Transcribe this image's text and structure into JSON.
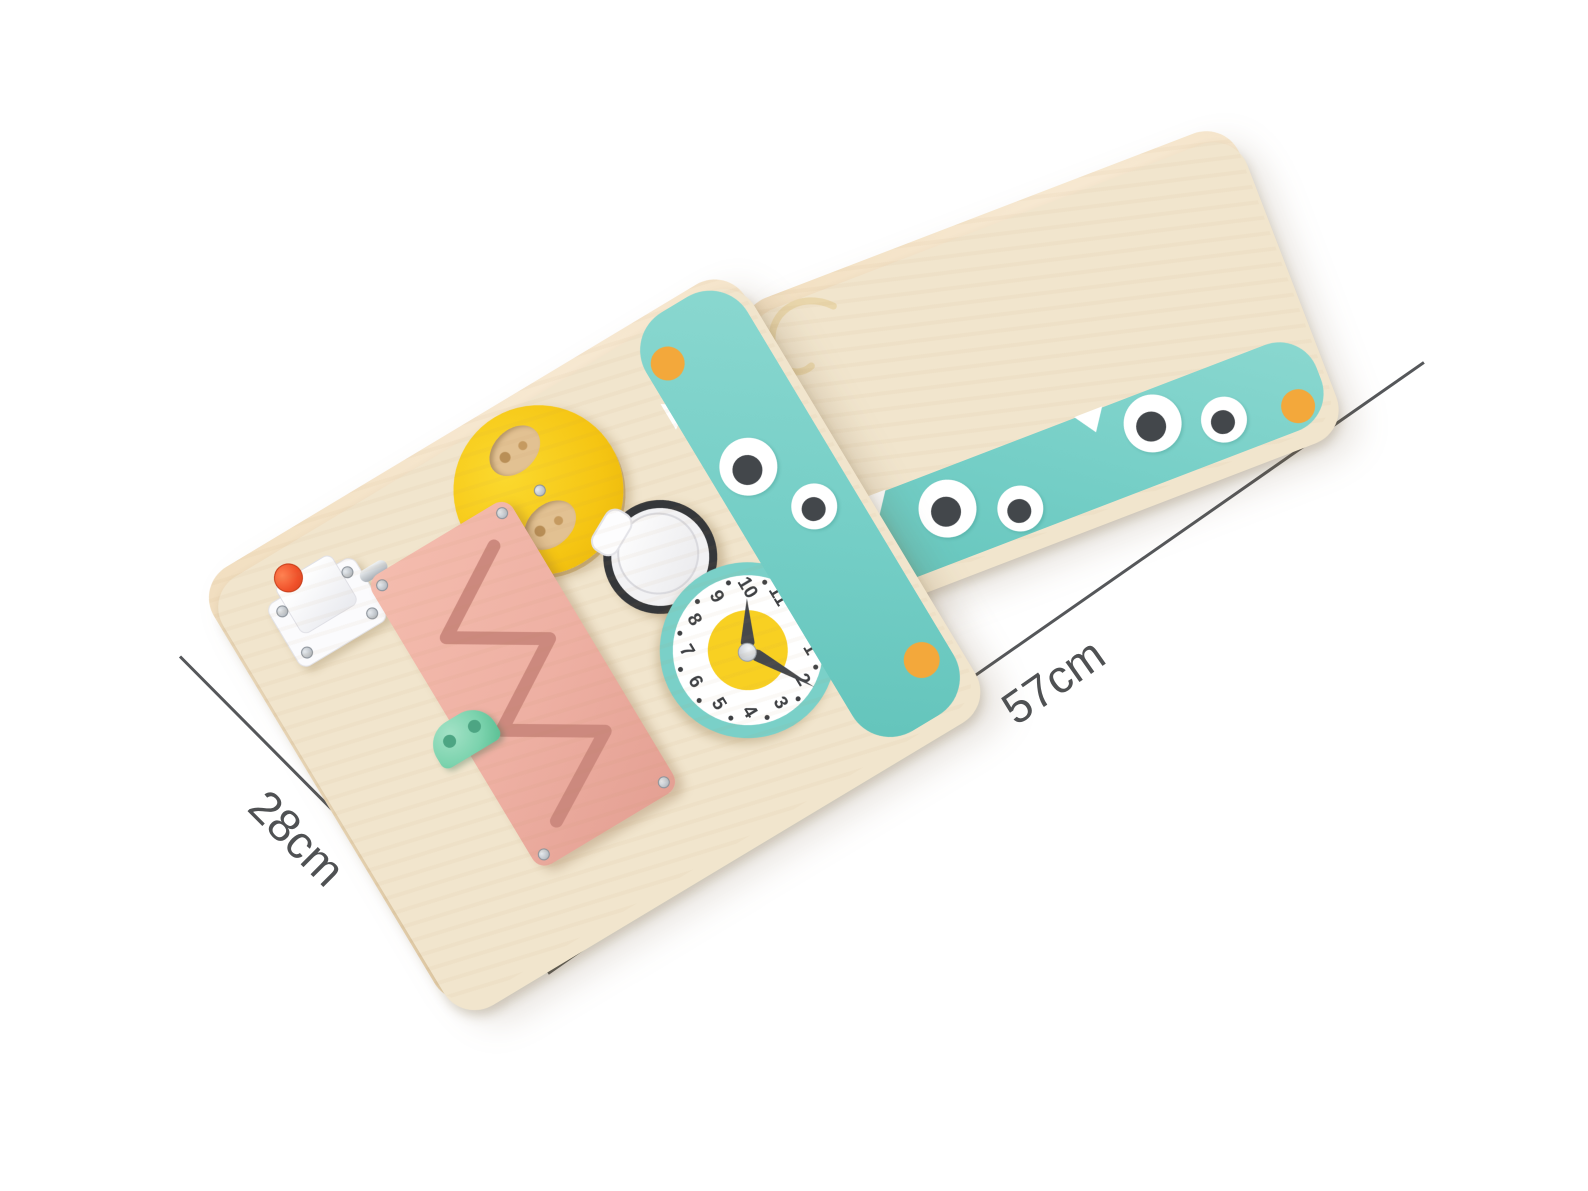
{
  "image": {
    "description": "Product photo of a two-panel wooden Montessori busy board shown open at an angle, with size annotations",
    "background": "#ffffff"
  },
  "annotations": {
    "depth": {
      "label": "28cm",
      "angle_deg": 45
    },
    "width": {
      "label": "57cm",
      "angle_deg": -35
    },
    "line_color": "#55575a",
    "text_color": "#4f5153"
  },
  "clock": {
    "numbers": [
      "12",
      "1",
      "2",
      "3",
      "4",
      "5",
      "6",
      "7",
      "8",
      "9",
      "10",
      "11"
    ],
    "hour_hand_points_to": "10",
    "minute_hand_points_to": "2",
    "dial_dots": 12,
    "ring_color": "#7ad0c8",
    "center_color": "#f8d022"
  },
  "palette": {
    "wood": "#f3e1c4",
    "teal_strip": "#74cec6",
    "mint_cap": "#5ecbb2",
    "pink": "#eeb0a3",
    "yellow": "#f5c513",
    "felt_crest": "#f6c97c",
    "bead_yellow": "#fcd020",
    "bead_cyan": "#a8e4e1",
    "orange_dot": "#f3a83b",
    "metal": "#c2c8cd",
    "red_button": "#f0512a",
    "blue_edge": "#5ca8d4"
  },
  "board": {
    "left_panel": {
      "items": [
        "push-button door latch",
        "rotating peek-a-boo disc",
        "twist bottle cap",
        "teaching clock",
        "zigzag slide track with car",
        "two-rod abacus"
      ],
      "abacus": {
        "yellow_beads": 11,
        "cyan_beads": 10
      },
      "monster": {
        "eyes": 2,
        "teeth": 2,
        "dots": 2
      }
    },
    "right_panel": {
      "items": [
        "double rocker light switch",
        "yellow hinged door",
        "pink hinged door",
        "barrel bolt latches",
        "lock with key ring",
        "retractable tape measure with cord"
      ],
      "monster": {
        "eyes": 4,
        "teeth": 2,
        "dots": 2
      }
    }
  }
}
